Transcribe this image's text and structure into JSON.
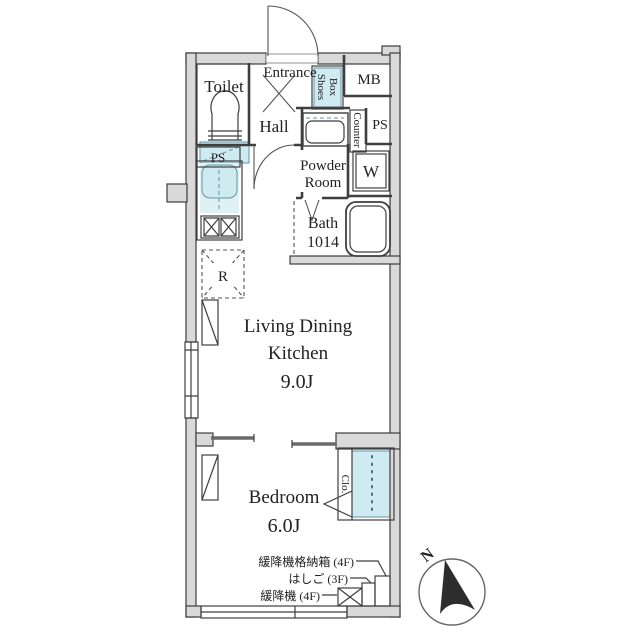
{
  "plan_title": "apartment-floor-plan",
  "colors": {
    "wall_fill": "#d9d9d9",
    "line": "#3c3c3c",
    "fixture_fill": "#cfeaf0",
    "text": "#222222"
  },
  "rooms": {
    "toilet": {
      "label": "Toilet"
    },
    "entrance": {
      "label": "Entrance"
    },
    "hall": {
      "label": "Hall"
    },
    "shoes_box": {
      "line1": "Shoes",
      "line2": "Box"
    },
    "mb": {
      "label": "MB"
    },
    "ps_top_left": {
      "label": "PS"
    },
    "ps_right": {
      "label": "PS"
    },
    "counter": {
      "label": "Counter"
    },
    "powder_room": {
      "line1": "Powder",
      "line2": "Room"
    },
    "washer": {
      "label": "W"
    },
    "bath": {
      "line1": "Bath",
      "line2": "1014"
    },
    "refrigerator": {
      "label": "R"
    },
    "ldk": {
      "line1": "Living Dining",
      "line2": "Kitchen",
      "size": "9.0J"
    },
    "bedroom": {
      "label": "Bedroom",
      "size": "6.0J"
    },
    "closet": {
      "label": "Clo."
    }
  },
  "annotations": {
    "escape_hatch_box": "緩降機格納箱 (4F)",
    "ladder": "はしご (3F)",
    "escape_device": "緩降機 (4F)"
  },
  "compass": {
    "north": "N"
  }
}
